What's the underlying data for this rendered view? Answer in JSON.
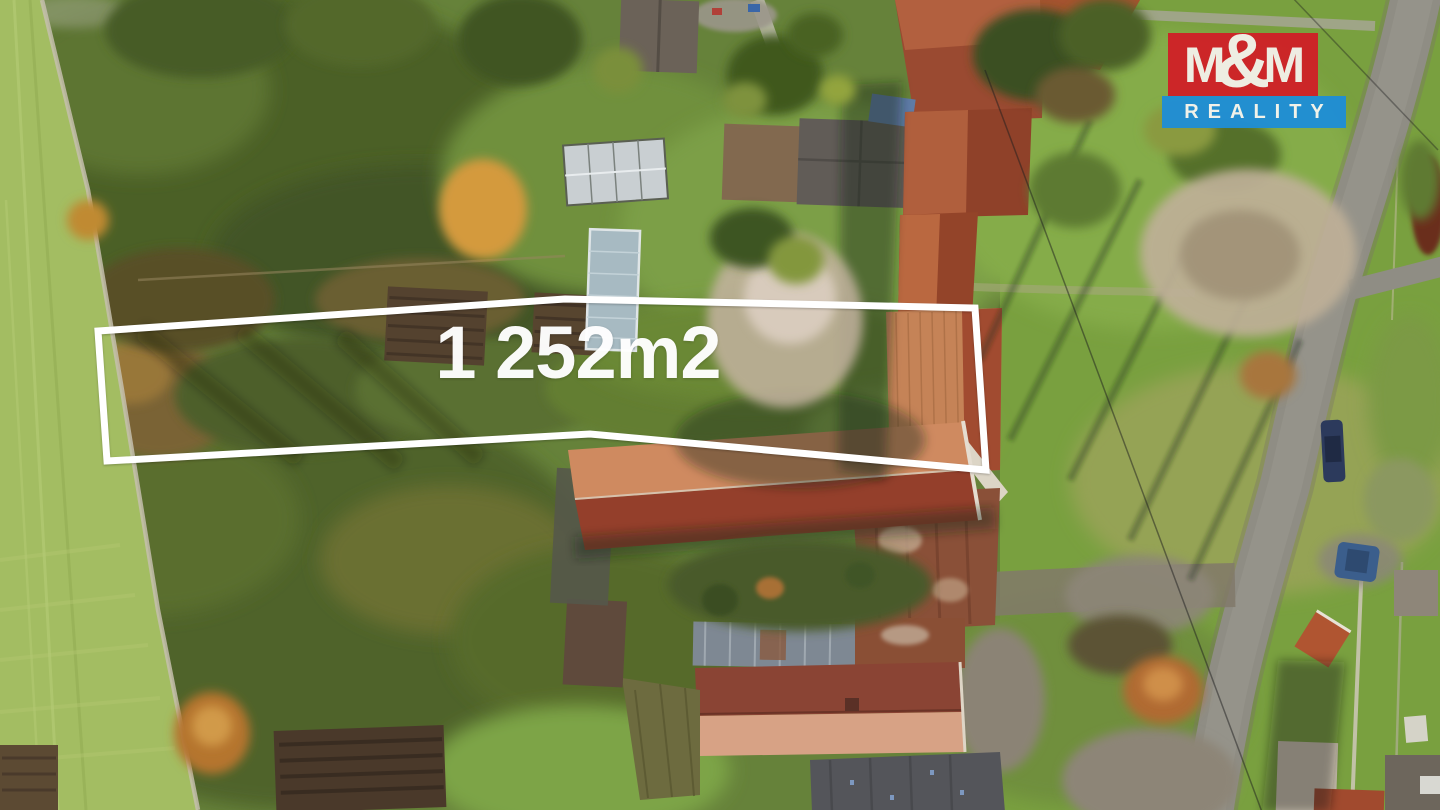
{
  "overlay": {
    "area_label": "1 252m2",
    "outline_color": "#ffffff",
    "outline_points": "98,331 565,299 975,308 986,470 590,434 107,461"
  },
  "logo": {
    "m_left": "M",
    "ampersand": "&",
    "m_right": "M",
    "reality": "REALITY",
    "red_bg": "#cf2127",
    "blue_bg": "#1f8ed6",
    "text_color": "#f3f0e9"
  }
}
